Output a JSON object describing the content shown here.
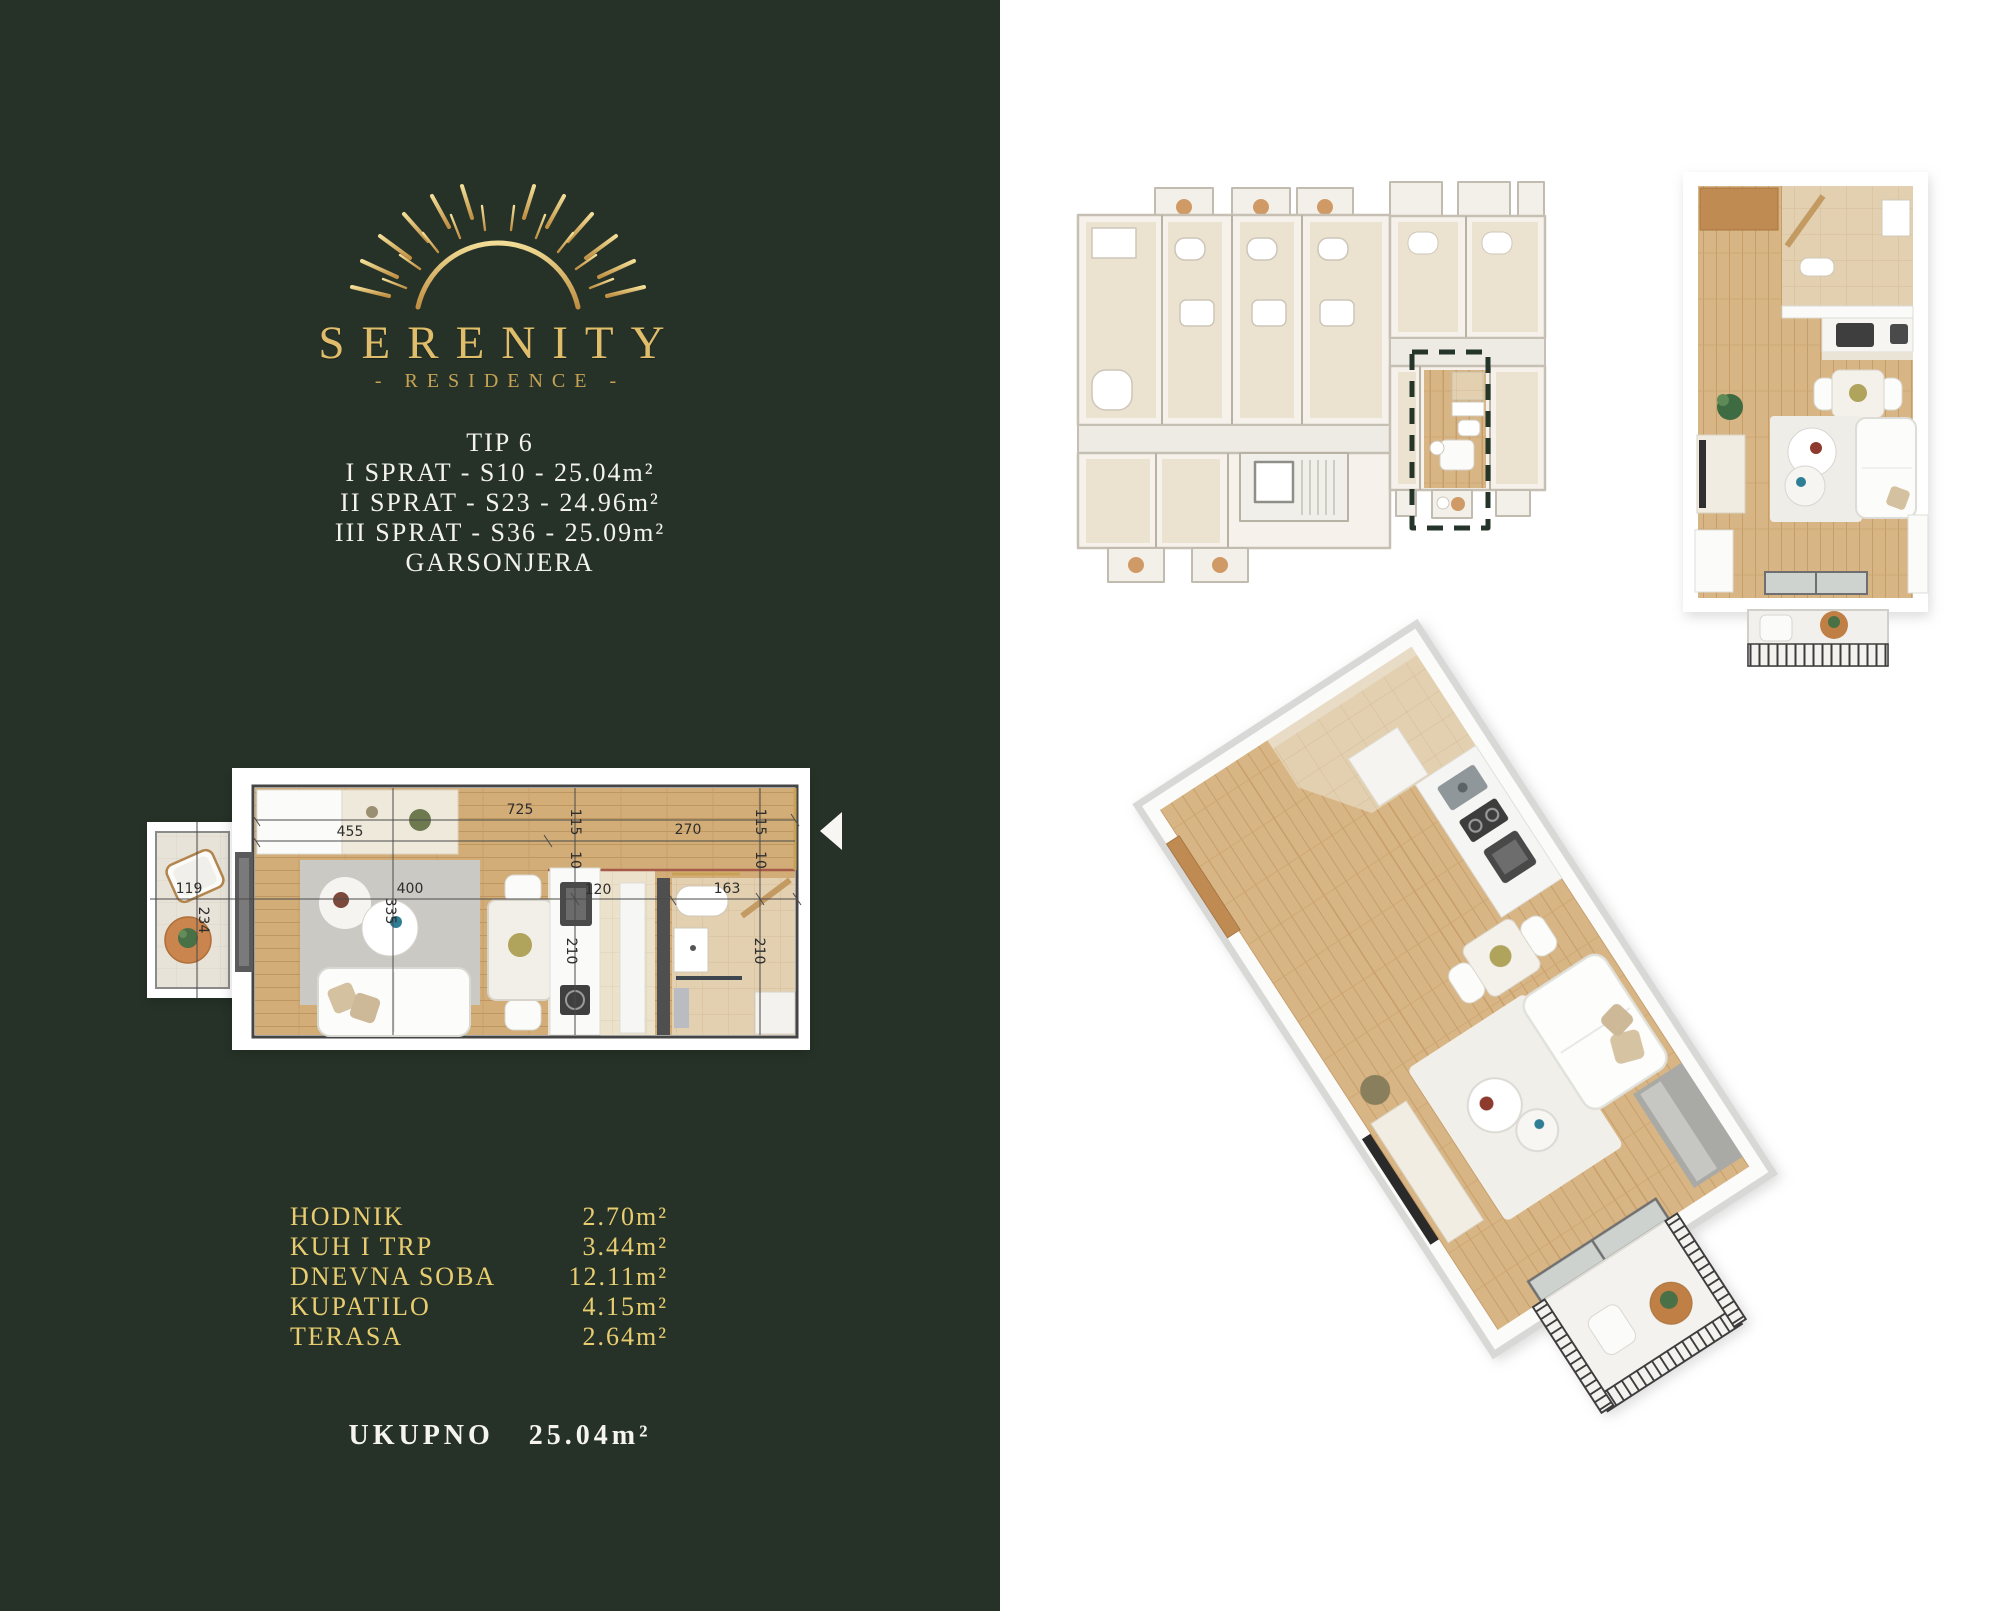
{
  "brand": {
    "name": "SERENITY",
    "subtitle": "- RESIDENCE -",
    "logo_icon": "sunrise-icon",
    "gold": "#d9b564",
    "panel_green": "#263228"
  },
  "unit": {
    "type": "TIP 6",
    "floors": [
      "I SPRAT - S10 - 25.04m²",
      "II SPRAT - S23 - 24.96m²",
      "III SPRAT - S36 - 25.09m²"
    ],
    "category": "GARSONJERA"
  },
  "rooms": [
    {
      "name": "HODNIK",
      "area": "2.70m²"
    },
    {
      "name": "KUH I TRP",
      "area": "3.44m²"
    },
    {
      "name": "DNEVNA SOBA",
      "area": "12.11m²"
    },
    {
      "name": "KUPATILO",
      "area": "4.15m²"
    },
    {
      "name": "TERASA",
      "area": "2.64m²"
    }
  ],
  "total": {
    "label": "UKUPNO",
    "area": "25.04m²"
  },
  "plan2d": {
    "dims": {
      "total_width": "725",
      "living_width": "455",
      "hall_width": "270",
      "wall_left": "115",
      "wall_right": "115",
      "gap_left": "10",
      "gap_right": "10",
      "kitchen_width": "120",
      "bath_width": "163",
      "kitchen_depth": "210",
      "bath_depth": "210",
      "table_dim": "400",
      "sofa_dim": "335",
      "terrace_width": "119",
      "terrace_depth": "234"
    }
  }
}
